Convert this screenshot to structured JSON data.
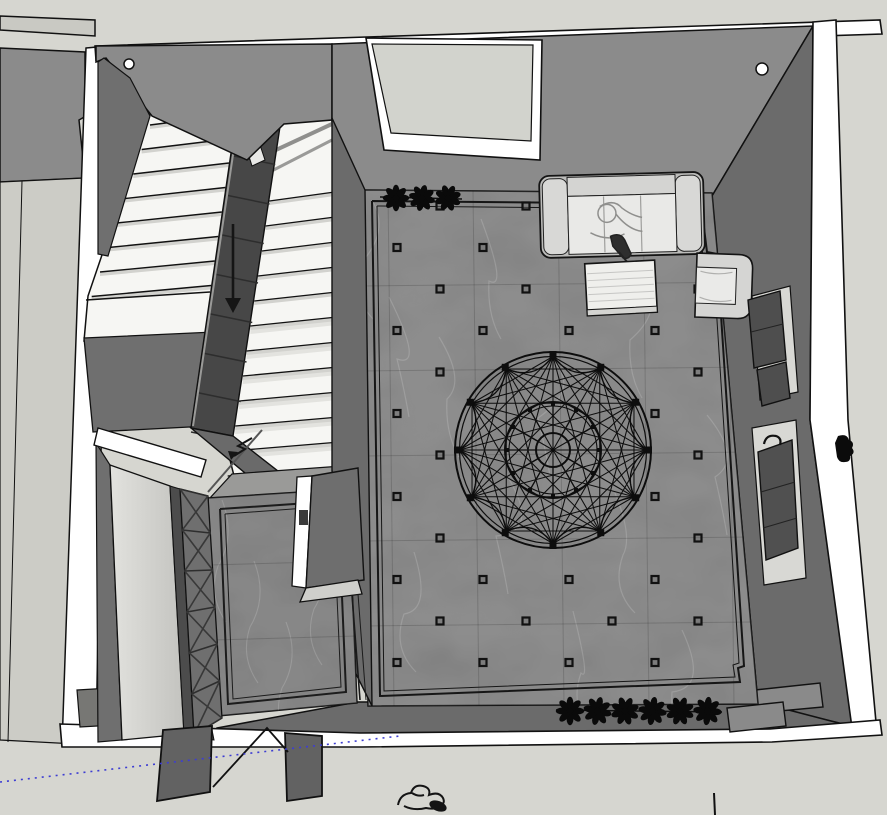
{
  "scene": {
    "description": "Top-down 3D model view: U-shaped staircase, entry vestibule and large hall with circular floor medallion, sofa group, planted borders and open double doors",
    "background_color": "#d6d6d0",
    "colors": {
      "wall_top_white": "#ffffff",
      "wall_gray": "#8b8b8b",
      "wall_dark": "#6b6b6b",
      "stringer_dark": "#474747",
      "floor_marble": "#7a7a7a",
      "vestibule_marble": "#747474",
      "alcove_floor": "#d2d3cd",
      "left_space_floor": "#ccccc6",
      "stair_tread": "#f6f6f3",
      "stair_tread_shade": "#d2d2ce",
      "furniture_frame": "#bcbcba",
      "furniture_seat": "#e9e9e7",
      "panel_dark": "#4e4e4e",
      "door_leaf": "#626262",
      "line_black": "#111111",
      "guide_blue": "#3d3dd2"
    },
    "medallion": {
      "cx": 553,
      "cy": 450,
      "outer_radius": 98,
      "ring_gap": 4.5,
      "points": 12,
      "inner_radius": 48,
      "hub_radius": 17,
      "scallop_radius": 72,
      "chord_offsets": [
        2,
        3,
        4,
        5,
        6
      ]
    },
    "floor_dots": {
      "origin_x": 397,
      "origin_y": 206,
      "dx": 43,
      "dy": 41.5,
      "cols": 8,
      "rows": 12,
      "parity": "odd",
      "size": 7,
      "exclusion_radius": 108,
      "max_x": 704,
      "max_y": 692
    },
    "plant_rows": [
      {
        "id": "top",
        "count": 3,
        "x": 396,
        "y": 198,
        "spacing": 26,
        "petals": 8,
        "radius": 13
      },
      {
        "id": "bottom",
        "count": 6,
        "x": 570,
        "y": 711,
        "spacing": 27.5,
        "petals": 8,
        "radius": 14
      }
    ],
    "staircase": {
      "left_flight_treads": 8,
      "right_flight_treads": 12,
      "direction": "down",
      "arrow": {
        "x": 233,
        "y1": 224,
        "y2": 300
      }
    },
    "x_brace_cells": 6,
    "guide_line": {
      "x1": 0,
      "y1": 782,
      "x2": 400,
      "y2": 736
    },
    "furniture": [
      "sofa",
      "coffee-table",
      "armchair",
      "wall-panel-upper",
      "wall-panel-lower"
    ],
    "doors": 2
  }
}
